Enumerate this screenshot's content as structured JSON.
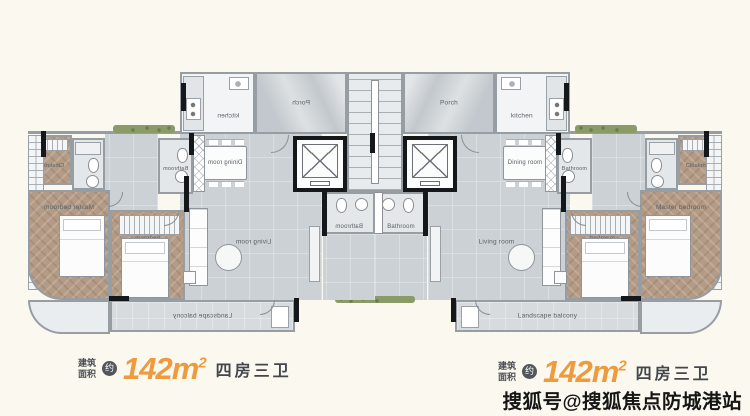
{
  "background": "#fbf8ef",
  "plan": {
    "rooms": {
      "porch": "Porch",
      "kitchen": "kitchen",
      "dining": "Dining room",
      "bathroom_center": "Bathroom",
      "bathroom_guest": "Bathroom",
      "cloakroom": "Cloakroom",
      "master_bedroom": "Master bedroom",
      "bedroom": "bedroom",
      "living": "Living room",
      "balcony": "Landscape balcony"
    }
  },
  "specs": {
    "left": {
      "area_label_line1": "建筑",
      "area_label_line2": "面积",
      "approx_badge": "约",
      "area_value": "142m",
      "area_sup": "2",
      "layout_text": "四房三卫"
    },
    "right": {
      "area_label_line1": "建筑",
      "area_label_line2": "面积",
      "approx_badge": "约",
      "area_value": "142m",
      "area_sup": "2",
      "layout_text": "四房三卫"
    }
  },
  "watermark": "搜狐号@搜狐焦点防城港站",
  "colors": {
    "accent_orange": "#ef9a3d",
    "wall_gray": "#969da3",
    "wall_black": "#15181a",
    "wood": "#b49b86",
    "floor_gray": "#ccd1d5"
  }
}
